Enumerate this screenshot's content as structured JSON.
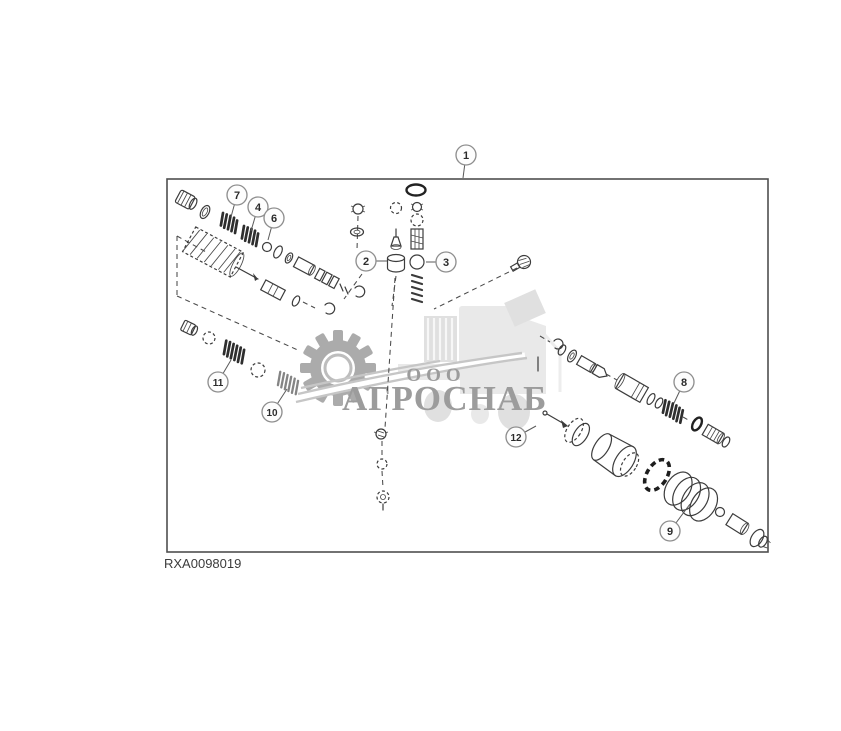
{
  "figure": {
    "image_label": "RXA0098019",
    "description": "exploded-parts-diagram",
    "callouts": [
      {
        "number": "1",
        "cx": 466,
        "cy": 155,
        "lx": 463,
        "ly": 178
      },
      {
        "number": "2",
        "cx": 366,
        "cy": 261,
        "lx": 387,
        "ly": 261
      },
      {
        "number": "3",
        "cx": 446,
        "cy": 262,
        "lx": 426,
        "ly": 262
      },
      {
        "number": "4",
        "cx": 258,
        "cy": 207,
        "lx": 251,
        "ly": 231
      },
      {
        "number": "6",
        "cx": 274,
        "cy": 218,
        "lx": 268,
        "ly": 240
      },
      {
        "number": "7",
        "cx": 237,
        "cy": 195,
        "lx": 231,
        "ly": 217
      },
      {
        "number": "8",
        "cx": 684,
        "cy": 382,
        "lx": 674,
        "ly": 403
      },
      {
        "number": "9",
        "cx": 670,
        "cy": 531,
        "lx": 690,
        "ly": 504
      },
      {
        "number": "10",
        "cx": 272,
        "cy": 412,
        "lx": 287,
        "ly": 389
      },
      {
        "number": "11",
        "cx": 218,
        "cy": 382,
        "lx": 231,
        "ly": 360
      },
      {
        "number": "12",
        "cx": 516,
        "cy": 437,
        "lx": 536,
        "ly": 426
      }
    ]
  },
  "watermark": {
    "company_prefix": "ООО",
    "company_name": "АГРОСНАБ"
  },
  "colors": {
    "background": "#ffffff",
    "line_art": "#3c3c3c",
    "frame_border": "#4f4f4f",
    "callout_ring": "#8f8f8f",
    "callout_text": "#2b2b2b",
    "watermark_text": "#9c9c9c",
    "watermark_gear": "#ababab",
    "watermark_silhouette": "#e9e9e9",
    "spring_dark": "#2e2e2e"
  }
}
